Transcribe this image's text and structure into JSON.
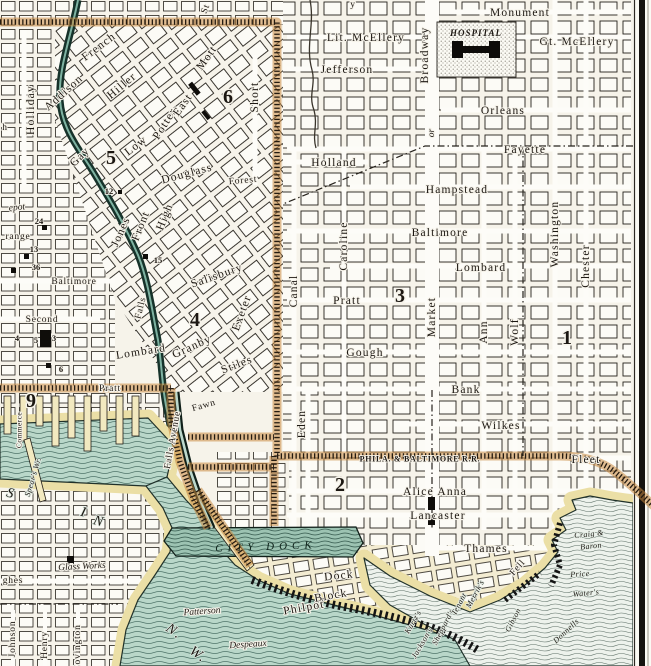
{
  "map": {
    "region": "harbor city grid with basin, city dock and wharves",
    "colors": {
      "paper": "#f6f3ea",
      "block_fill": "#fcfbf6",
      "ink": "#1c1712",
      "water_teal": "#b9d7c9",
      "water_pale": "#edf2ec",
      "dock_water": "#a3c8b8",
      "shore_cream": "#ebdfa6",
      "railroad_orange": "#c9893e",
      "stream_dark": "#16322a"
    },
    "railroad_name": "PHILA. & BALTIMORE R.R.",
    "hospital_name": "HOSPITAL",
    "city_dock_name": "CITY DOCK",
    "district_numbers": [
      "1",
      "2",
      "3",
      "4",
      "5",
      "6",
      "9"
    ],
    "building_numbers": [
      "12",
      "24",
      "13",
      "14",
      "15",
      "4",
      "5",
      "3",
      "6"
    ]
  },
  "labels": [
    {
      "name": "street-monument",
      "text": "Monument",
      "x": 520,
      "y": 13,
      "rot": 0,
      "cls": "st"
    },
    {
      "name": "street-lit-mcellery",
      "text": "Lit. McEllery",
      "x": 366,
      "y": 38,
      "rot": 0,
      "cls": "st"
    },
    {
      "name": "street-gt-mcellery",
      "text": "Gt. McEllery",
      "x": 577,
      "y": 42,
      "rot": 0,
      "cls": "st"
    },
    {
      "name": "street-jefferson",
      "text": "Jefferson",
      "x": 347,
      "y": 70,
      "rot": 0,
      "cls": "st"
    },
    {
      "name": "street-orleans",
      "text": "Orleans",
      "x": 503,
      "y": 111,
      "rot": 0,
      "cls": "st"
    },
    {
      "name": "street-fayette",
      "text": "Fayette",
      "x": 525,
      "y": 150,
      "rot": 0,
      "cls": "st"
    },
    {
      "name": "street-holland",
      "text": "Holland",
      "x": 334,
      "y": 163,
      "rot": 0,
      "cls": "st"
    },
    {
      "name": "street-hampstead",
      "text": "Hampstead",
      "x": 457,
      "y": 190,
      "rot": 0,
      "cls": "st"
    },
    {
      "name": "street-baltimore-e",
      "text": "Baltimore",
      "x": 440,
      "y": 233,
      "rot": 0,
      "cls": "st"
    },
    {
      "name": "street-lombard-e",
      "text": "Lombard",
      "x": 481,
      "y": 268,
      "rot": 0,
      "cls": "st"
    },
    {
      "name": "street-pratt-e",
      "text": "Pratt",
      "x": 347,
      "y": 301,
      "rot": 0,
      "cls": "st"
    },
    {
      "name": "street-gough",
      "text": "Gough",
      "x": 365,
      "y": 353,
      "rot": 0,
      "cls": "st"
    },
    {
      "name": "street-bank",
      "text": "Bank",
      "x": 466,
      "y": 390,
      "rot": 0,
      "cls": "st"
    },
    {
      "name": "street-wilkes",
      "text": "Wilkes",
      "x": 501,
      "y": 426,
      "rot": 0,
      "cls": "st"
    },
    {
      "name": "street-fleet",
      "text": "Fleet",
      "x": 586,
      "y": 460,
      "rot": 0,
      "cls": "st"
    },
    {
      "name": "street-alice-anna",
      "text": "Alice Anna",
      "x": 435,
      "y": 492,
      "rot": 0,
      "cls": "st"
    },
    {
      "name": "street-lancaster",
      "text": "Lancaster",
      "x": 438,
      "y": 516,
      "rot": 0,
      "cls": "st"
    },
    {
      "name": "street-thames",
      "text": "Thames",
      "x": 486,
      "y": 549,
      "rot": 0,
      "cls": "st"
    },
    {
      "name": "street-baltimore-w",
      "text": "Baltimore",
      "x": 74,
      "y": 282,
      "rot": 0,
      "cls": "stsm"
    },
    {
      "name": "street-second",
      "text": "Second",
      "x": 42,
      "y": 320,
      "rot": 0,
      "cls": "stsm"
    },
    {
      "name": "street-pratt-w",
      "text": "Pratt",
      "x": 110,
      "y": 389,
      "rot": 0,
      "cls": "stsm"
    },
    {
      "name": "street-forest",
      "text": "Forest",
      "x": 243,
      "y": 181,
      "rot": -5,
      "cls": "stsm"
    },
    {
      "name": "street-dock",
      "text": "Dock",
      "x": 339,
      "y": 576,
      "rot": -6,
      "cls": "st"
    },
    {
      "name": "street-block",
      "text": "Block",
      "x": 331,
      "y": 596,
      "rot": -10,
      "cls": "st"
    },
    {
      "name": "street-philpot",
      "text": "Philpot",
      "x": 304,
      "y": 608,
      "rot": -10,
      "cls": "st"
    },
    {
      "name": "street-hughes-frag",
      "text": "ghes",
      "x": 13,
      "y": 581,
      "rot": 0,
      "cls": "stsm"
    },
    {
      "name": "poi-glass-works",
      "text": "Glass Works",
      "x": 82,
      "y": 567,
      "rot": -3,
      "cls": "ital"
    },
    {
      "name": "frag-depot",
      "text": "epot",
      "x": 17,
      "y": 208,
      "rot": -5,
      "cls": "ital"
    },
    {
      "name": "frag-orange",
      "text": "range",
      "x": 18,
      "y": 237,
      "rot": 0,
      "cls": "stsm"
    },
    {
      "name": "railroad-label",
      "text": "PHILA. & BALTIMORE R.R.",
      "x": 420,
      "y": 459,
      "rot": 0,
      "cls": "rr"
    },
    {
      "name": "citydock-label",
      "text": "CITY DOCK",
      "x": 266,
      "y": 547,
      "rot": -2,
      "cls": "cd"
    },
    {
      "name": "hospital-label",
      "text": "HOSPITAL",
      "x": 476,
      "y": 33,
      "rot": 0,
      "cls": "hosp"
    },
    {
      "name": "street-holliday",
      "text": "Holliday",
      "x": 31,
      "y": 110,
      "rot": -90,
      "cls": "st"
    },
    {
      "name": "street-short",
      "text": "Short",
      "x": 255,
      "y": 97,
      "rot": -90,
      "cls": "st"
    },
    {
      "name": "street-broadway",
      "text": "Broadway",
      "x": 425,
      "y": 55,
      "rot": -90,
      "cls": "st"
    },
    {
      "name": "frag-or",
      "text": "or",
      "x": 432,
      "y": 133,
      "rot": -90,
      "cls": "ital"
    },
    {
      "name": "street-market",
      "text": "Market",
      "x": 432,
      "y": 317,
      "rot": -90,
      "cls": "st"
    },
    {
      "name": "street-canal",
      "text": "Canal",
      "x": 294,
      "y": 291,
      "rot": -90,
      "cls": "st"
    },
    {
      "name": "street-caroline",
      "text": "Caroline",
      "x": 344,
      "y": 246,
      "rot": -90,
      "cls": "st"
    },
    {
      "name": "street-eden",
      "text": "Eden",
      "x": 302,
      "y": 424,
      "rot": -90,
      "cls": "st"
    },
    {
      "name": "street-ann",
      "text": "Ann",
      "x": 484,
      "y": 332,
      "rot": -90,
      "cls": "st"
    },
    {
      "name": "street-wolf",
      "text": "Wolf",
      "x": 515,
      "y": 332,
      "rot": -90,
      "cls": "st"
    },
    {
      "name": "street-washington",
      "text": "Washington",
      "x": 555,
      "y": 234,
      "rot": -90,
      "cls": "st"
    },
    {
      "name": "street-chester",
      "text": "Chester",
      "x": 586,
      "y": 266,
      "rot": -90,
      "cls": "st"
    },
    {
      "name": "frag-commerce",
      "text": "Commerce",
      "x": 19,
      "y": 430,
      "rot": -90,
      "cls": "tiny"
    },
    {
      "name": "street-johnson",
      "text": "Johnson",
      "x": 13,
      "y": 639,
      "rot": -90,
      "cls": "stsm"
    },
    {
      "name": "street-henry",
      "text": "Henry",
      "x": 45,
      "y": 645,
      "rot": -90,
      "cls": "stsm"
    },
    {
      "name": "street-covington",
      "text": "Covington",
      "x": 78,
      "y": 648,
      "rot": -90,
      "cls": "stsm"
    },
    {
      "name": "street-falls-avenue",
      "text": "Falls Avenue",
      "x": 173,
      "y": 440,
      "rot": -80,
      "cls": "stsm"
    },
    {
      "name": "street-falls",
      "text": "Falls",
      "x": 141,
      "y": 308,
      "rot": -76,
      "cls": "stsm"
    },
    {
      "name": "frag-st",
      "text": "St",
      "x": 206,
      "y": 9,
      "rot": -70,
      "cls": "stsm"
    },
    {
      "name": "frag-y",
      "text": "y",
      "x": 353,
      "y": 5,
      "rot": 0,
      "cls": "stsm"
    },
    {
      "name": "frag-h",
      "text": "h",
      "x": 5,
      "y": 128,
      "rot": 0,
      "cls": "stsm"
    },
    {
      "name": "street-french",
      "text": "French",
      "x": 99,
      "y": 47,
      "rot": -37,
      "cls": "st"
    },
    {
      "name": "street-addison",
      "text": "Addison",
      "x": 64,
      "y": 93,
      "rot": -42,
      "cls": "st"
    },
    {
      "name": "street-hiller",
      "text": "Hiller",
      "x": 122,
      "y": 86,
      "rot": -40,
      "cls": "st"
    },
    {
      "name": "street-gay",
      "text": "Gay",
      "x": 80,
      "y": 157,
      "rot": -45,
      "cls": "st"
    },
    {
      "name": "street-low",
      "text": "Low",
      "x": 136,
      "y": 146,
      "rot": -38,
      "cls": "st"
    },
    {
      "name": "street-potter",
      "text": "Potter",
      "x": 165,
      "y": 124,
      "rot": -58,
      "cls": "st"
    },
    {
      "name": "street-east",
      "text": "East",
      "x": 183,
      "y": 105,
      "rot": -55,
      "cls": "st"
    },
    {
      "name": "street-mott",
      "text": "Mott",
      "x": 207,
      "y": 58,
      "rot": -55,
      "cls": "st"
    },
    {
      "name": "street-douglass",
      "text": "Douglass",
      "x": 187,
      "y": 174,
      "rot": -15,
      "cls": "st"
    },
    {
      "name": "street-jones",
      "text": "Jones",
      "x": 121,
      "y": 232,
      "rot": -66,
      "cls": "st"
    },
    {
      "name": "street-front",
      "text": "Front",
      "x": 141,
      "y": 226,
      "rot": -68,
      "cls": "st"
    },
    {
      "name": "street-high",
      "text": "High",
      "x": 165,
      "y": 217,
      "rot": -68,
      "cls": "st"
    },
    {
      "name": "street-salisbury",
      "text": "Salisbury",
      "x": 217,
      "y": 276,
      "rot": -19,
      "cls": "st"
    },
    {
      "name": "street-exeter",
      "text": "Exeter",
      "x": 242,
      "y": 313,
      "rot": -70,
      "cls": "st"
    },
    {
      "name": "street-granby",
      "text": "Granby",
      "x": 192,
      "y": 347,
      "rot": -24,
      "cls": "st"
    },
    {
      "name": "street-lombard-w",
      "text": "Lombard",
      "x": 141,
      "y": 352,
      "rot": -9,
      "cls": "st"
    },
    {
      "name": "street-stiles",
      "text": "Stiles",
      "x": 237,
      "y": 365,
      "rot": -21,
      "cls": "st"
    },
    {
      "name": "street-fawn",
      "text": "Fawn",
      "x": 204,
      "y": 406,
      "rot": -16,
      "cls": "stsm"
    },
    {
      "name": "street-fell",
      "text": "Fell",
      "x": 518,
      "y": 568,
      "rot": -48,
      "cls": "stsm"
    },
    {
      "name": "wharf-craig",
      "text": "Craig &",
      "x": 589,
      "y": 534,
      "rot": -6,
      "cls": "wharf"
    },
    {
      "name": "wharf-baron",
      "text": "Baron",
      "x": 591,
      "y": 546,
      "rot": -6,
      "cls": "wharf"
    },
    {
      "name": "wharf-price",
      "text": "Price",
      "x": 580,
      "y": 574,
      "rot": -4,
      "cls": "wharf"
    },
    {
      "name": "wharf-waters",
      "text": "Water's",
      "x": 586,
      "y": 593,
      "rot": -6,
      "cls": "wharf"
    },
    {
      "name": "wharf-donnells",
      "text": "Donnells",
      "x": 566,
      "y": 631,
      "rot": -43,
      "cls": "wharf"
    },
    {
      "name": "wharf-gibson",
      "text": "Gibson",
      "x": 513,
      "y": 620,
      "rot": -63,
      "cls": "wharf"
    },
    {
      "name": "wharf-merriks",
      "text": "Merrik's",
      "x": 475,
      "y": 594,
      "rot": -62,
      "cls": "wharf"
    },
    {
      "name": "wharf-sheppards",
      "text": "Sheppard's",
      "x": 443,
      "y": 627,
      "rot": -63,
      "cls": "wharf"
    },
    {
      "name": "wharf-tenant",
      "text": "Tenant",
      "x": 459,
      "y": 604,
      "rot": -62,
      "cls": "wharf"
    },
    {
      "name": "wharf-kurtzs",
      "text": "Kurtz's",
      "x": 413,
      "y": 622,
      "rot": -60,
      "cls": "wharf"
    },
    {
      "name": "wharf-jacksons",
      "text": "Jackson's",
      "x": 422,
      "y": 643,
      "rot": -60,
      "cls": "wharf"
    },
    {
      "name": "wharf-spears",
      "text": "Spear's Wr.",
      "x": 33,
      "y": 477,
      "rot": -73,
      "cls": "wharf"
    },
    {
      "name": "wharf-patterson",
      "text": "Patterson",
      "x": 202,
      "y": 612,
      "rot": -4,
      "cls": "ital"
    },
    {
      "name": "wharf-despeaux",
      "text": "Despeaux",
      "x": 248,
      "y": 645,
      "rot": -4,
      "cls": "ital"
    },
    {
      "name": "water-basin-s",
      "text": "S",
      "x": 11,
      "y": 494,
      "rot": 15,
      "cls": "wlg"
    },
    {
      "name": "water-basin-i",
      "text": "I",
      "x": 84,
      "y": 513,
      "rot": 15,
      "cls": "wlg"
    },
    {
      "name": "water-basin-n",
      "text": "N",
      "x": 99,
      "y": 522,
      "rot": 15,
      "cls": "wlg"
    },
    {
      "name": "water-nw-n",
      "text": "N.",
      "x": 174,
      "y": 632,
      "rot": 35,
      "cls": "wlg"
    },
    {
      "name": "water-nw-w",
      "text": "W.",
      "x": 198,
      "y": 655,
      "rot": 35,
      "cls": "wlg"
    },
    {
      "name": "district-6",
      "text": "6",
      "x": 228,
      "y": 97,
      "rot": 0,
      "cls": "dist"
    },
    {
      "name": "district-5",
      "text": "5",
      "x": 111,
      "y": 158,
      "rot": 0,
      "cls": "dist"
    },
    {
      "name": "district-4",
      "text": "4",
      "x": 195,
      "y": 320,
      "rot": 0,
      "cls": "dist"
    },
    {
      "name": "district-3",
      "text": "3",
      "x": 400,
      "y": 296,
      "rot": 0,
      "cls": "dist"
    },
    {
      "name": "district-1",
      "text": "1",
      "x": 567,
      "y": 338,
      "rot": 0,
      "cls": "dist"
    },
    {
      "name": "district-2",
      "text": "2",
      "x": 340,
      "y": 485,
      "rot": 0,
      "cls": "dist"
    },
    {
      "name": "district-9",
      "text": "9",
      "x": 31,
      "y": 401,
      "rot": 0,
      "cls": "dist"
    },
    {
      "name": "bldg-num-12",
      "text": "12",
      "x": 109,
      "y": 191,
      "rot": 0,
      "cls": "num"
    },
    {
      "name": "bldg-num-24",
      "text": "24",
      "x": 39,
      "y": 221,
      "rot": 0,
      "cls": "num"
    },
    {
      "name": "bldg-num-13",
      "text": "13",
      "x": 34,
      "y": 249,
      "rot": 0,
      "cls": "num"
    },
    {
      "name": "bldg-num-14",
      "text": "36",
      "x": 36,
      "y": 267,
      "rot": 0,
      "cls": "num"
    },
    {
      "name": "bldg-num-15",
      "text": "15",
      "x": 158,
      "y": 260,
      "rot": 0,
      "cls": "num"
    },
    {
      "name": "bldg-num-4",
      "text": "4",
      "x": 17,
      "y": 338,
      "rot": 0,
      "cls": "num"
    },
    {
      "name": "bldg-num-5",
      "text": "5",
      "x": 36,
      "y": 340,
      "rot": 0,
      "cls": "num"
    },
    {
      "name": "bldg-num-3",
      "text": "3",
      "x": 54,
      "y": 338,
      "rot": 0,
      "cls": "num"
    },
    {
      "name": "bldg-num-6",
      "text": "6",
      "x": 61,
      "y": 369,
      "rot": 0,
      "cls": "num"
    }
  ]
}
